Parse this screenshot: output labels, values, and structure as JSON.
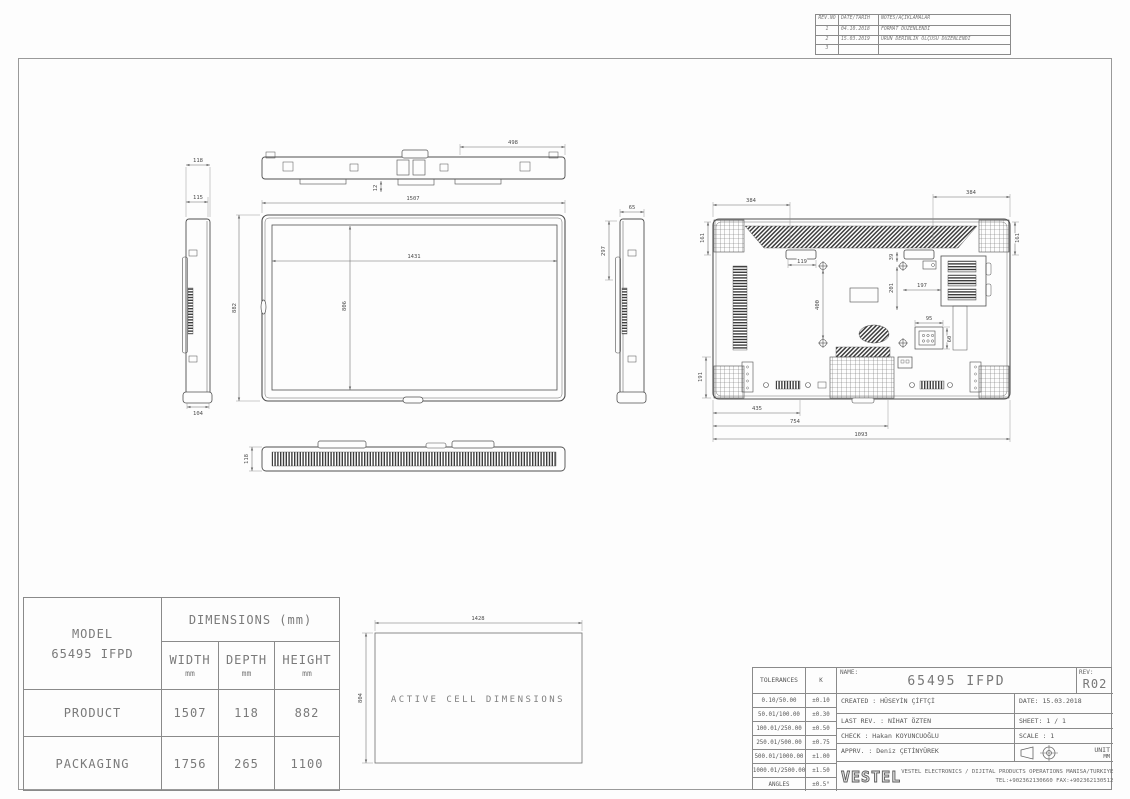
{
  "revision_table": {
    "headers": {
      "no": "REV.NO",
      "date": "DATE/TARİH",
      "note": "NOTES/AÇIKLAMALAR"
    },
    "rows": [
      {
        "no": "1",
        "date": "04.10.2018",
        "note": "FORMAT DÜZENLENDİ"
      },
      {
        "no": "2",
        "date": "15.03.2019",
        "note": "ÜRÜN DERİNLİK ÖLÇÜSÜ DÜZENLENDİ"
      },
      {
        "no": "3",
        "date": "",
        "note": ""
      }
    ]
  },
  "views": {
    "side_left": {
      "dim_top1": "118",
      "dim_top2": "115",
      "dim_bottom": "104"
    },
    "top": {
      "dim_width": "498",
      "dim_small": "12"
    },
    "front": {
      "dim_width_outer": "1507",
      "dim_width_active": "1431",
      "dim_height_outer": "882",
      "dim_height_active": "806"
    },
    "bottom": {
      "dim_height": "118"
    },
    "side_right": {
      "dim_depth": "65",
      "dim_height": "297"
    },
    "rear": {
      "dim_top_left": "384",
      "dim_top_right": "384",
      "dim_left_upper": "161",
      "dim_right_upper": "161",
      "dim_handle": "119",
      "dim_vesa_vertical": "400",
      "dim_small_a": "39",
      "dim_small_b": "201",
      "dim_small_c": "197",
      "dim_inlet_w": "95",
      "dim_inlet_h": "60",
      "dim_left_lower": "191",
      "dim_bottom_1": "435",
      "dim_bottom_2": "754",
      "dim_bottom_3": "1093"
    }
  },
  "active_cell": {
    "label": "ACTIVE CELL DIMENSIONS",
    "width": "1428",
    "height": "804"
  },
  "dimensions_table": {
    "model_label": "MODEL",
    "model_value": "65495 IFPD",
    "header": "DIMENSIONS (mm)",
    "columns": {
      "width": "WIDTH",
      "depth": "DEPTH",
      "height": "HEIGHT"
    },
    "unit": "mm",
    "product": {
      "label": "PRODUCT",
      "width": "1507",
      "depth": "118",
      "height": "882"
    },
    "packaging": {
      "label": "PACKAGING",
      "width": "1756",
      "depth": "265",
      "height": "1100"
    }
  },
  "title_block": {
    "tolerances": {
      "title": "TOLERANCES",
      "k": "K",
      "rows": [
        {
          "range": "0.10/50.00",
          "value": "±0.10"
        },
        {
          "range": "50.01/100.00",
          "value": "±0.30"
        },
        {
          "range": "100.01/250.00",
          "value": "±0.50"
        },
        {
          "range": "250.01/500.00",
          "value": "±0.75"
        },
        {
          "range": "500.01/1000.00",
          "value": "±1.00"
        },
        {
          "range": "1000.01/2500.00",
          "value": "±1.50"
        },
        {
          "range": "ANGLES",
          "value": "±0.5°"
        }
      ]
    },
    "name_label": "NAME:",
    "name_value": "65495 IFPD",
    "rev_label": "REV:",
    "rev_value": "R02",
    "created": "CREATED : HÜSEYİN ÇİFTÇİ",
    "date": "DATE: 15.03.2018",
    "last_rev": "LAST REV. : NİHAT ÖZTEN",
    "sheet": "SHEET: 1 / 1",
    "check": "CHECK : Hakan KOYUNCUOĞLU",
    "scale": "SCALE : 1",
    "apprv": "APPRV. : Deniz ÇETİNYÜREK",
    "unit_label": "UNIT",
    "unit_value": "MM",
    "logo": "VESTEL",
    "company_line1": "VESTEL ELECTRONICS / DIJITAL PRODUCTS OPERATIONS MANISA/TURKIYE",
    "company_line2": "TEL:+902362130660 FAX:+902362130512"
  }
}
